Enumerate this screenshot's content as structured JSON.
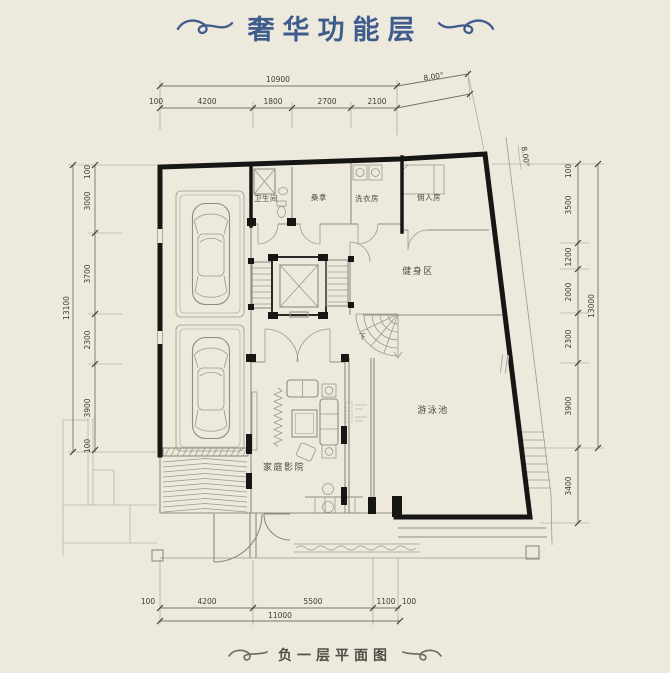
{
  "title": "奢华功能层",
  "caption": "负一层平面图",
  "rooms": {
    "bathroom": "卫生间",
    "sauna": "桑拿",
    "laundry": "洗衣房",
    "maid_room": "佣人房",
    "gym": "健身区",
    "pool": "游泳池",
    "home_theater": "家庭影院",
    "stair_down": "下"
  },
  "dims": {
    "top": {
      "total": "10900",
      "angle": "8.00°",
      "segments": [
        "100",
        "4200",
        "1800",
        "2700",
        "2100"
      ]
    },
    "bottom": {
      "total": "11000",
      "segments": [
        "100",
        "4200",
        "5500",
        "1100",
        "100"
      ]
    },
    "left": {
      "total": "13100",
      "segments": [
        "100",
        "3000",
        "3700",
        "2300",
        "3900",
        "100"
      ]
    },
    "right": {
      "total": "13000",
      "angle": "8.00°",
      "segments": [
        "100",
        "3500",
        "1200",
        "2000",
        "2300",
        "3900"
      ],
      "extension": "3400"
    }
  },
  "colors": {
    "background": "#edeadd",
    "wall": "#161614",
    "title_accent": "#3f5c8c",
    "caption_text": "#504e46",
    "drawing_line": "#8e8c7e",
    "dim_text": "#3c3c36"
  }
}
